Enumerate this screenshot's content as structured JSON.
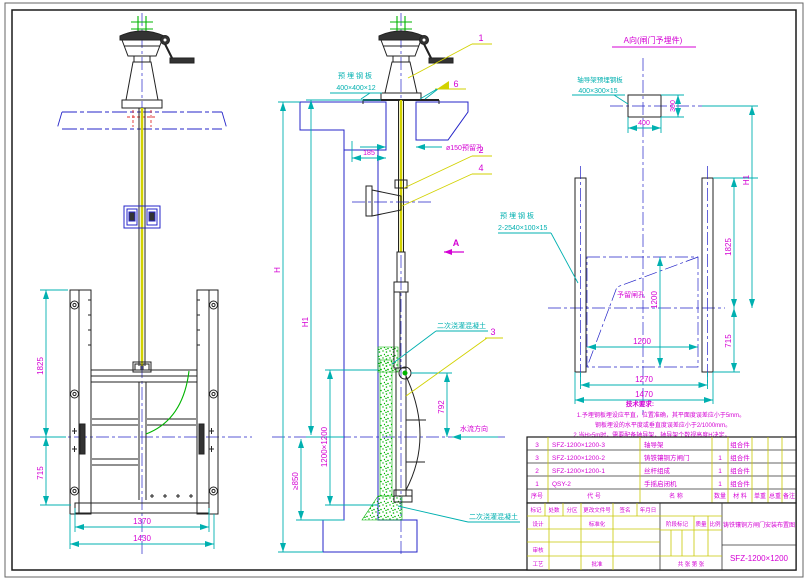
{
  "colors": {
    "dimension_lines": "#00b0b0",
    "dimension_text": "#d400d4",
    "concrete_hatch": "#00b400",
    "structure": "#2424c8",
    "leader_lines": "#d2d200",
    "background": "#ffffff"
  },
  "front": {
    "dims": {
      "h_upper": "1825",
      "h_lower": "715",
      "w_inner": "1370",
      "w_outer": "1430"
    }
  },
  "section": {
    "embed_plate_label": [
      "预埋钢板",
      "400×400×12"
    ],
    "hole_label": "ø150预留孔",
    "offset": "185",
    "H": "H",
    "H1": "H1",
    "opening": "1200×1200",
    "pit_depth": "≥850",
    "d792": "792",
    "flow": "水流方向",
    "section_mark": "A",
    "concrete_top": "二次浇灌混凝土",
    "concrete_bottom": "二次浇灌混凝土",
    "balloons": {
      "b1": "1",
      "b2": "2",
      "b3": "3",
      "b4": "4",
      "b6": "6"
    }
  },
  "embed": {
    "title": "A向(闸门予埋件)",
    "guide_plate_label": [
      "轴导架预埋钢板",
      "400×300×15"
    ],
    "embed_plate_label": [
      "预埋钢板",
      "2-2540×100×15"
    ],
    "hole_label": "予留闸孔",
    "dims": {
      "d300": "300",
      "d400": "400",
      "H1": "H1",
      "d1825": "1825",
      "d715": "715",
      "v1200": "1200",
      "h1200": "1200",
      "d1270": "1270",
      "d1470": "1470"
    }
  },
  "notes": {
    "title": "技术要求:",
    "lines": [
      "1.予埋钢板埋设应平直，位置准确，其平面度误差应小于5mm。",
      "钢板埋设的水平度或垂直度误差应小于2/1000mm。",
      "2.当H≥5m时，需要配备轴导架，轴导架个数视高度H决定。"
    ]
  },
  "parts": {
    "headers": [
      "序号",
      "代  号",
      "名  称",
      "数量",
      "材  料",
      "单重",
      "总重",
      "备注"
    ],
    "rows": [
      {
        "no": "3",
        "code": "SFZ-1200×1200-3",
        "name": "轴导架",
        "qty": "",
        "mat": "组合件"
      },
      {
        "no": "3",
        "code": "SFZ-1200×1200-2",
        "name": "铸铁镶铜方闸门",
        "qty": "1",
        "mat": "组合件"
      },
      {
        "no": "2",
        "code": "SFZ-1200×1200-1",
        "name": "丝杆组成",
        "qty": "1",
        "mat": "组合件"
      },
      {
        "no": "1",
        "code": "QSY-2",
        "name": "手摇启闭机",
        "qty": "1",
        "mat": "组合件"
      }
    ]
  },
  "tb": {
    "rev": [
      "标记",
      "处数",
      "分区",
      "更改文件号",
      "签名",
      "年月日"
    ],
    "design": "设计",
    "standardize": "标准化",
    "check": "审核",
    "craft": "工艺",
    "approve": "批准",
    "stage": "阶段标记",
    "mass": "质量",
    "scale": "比例",
    "sheet": "共  张  第  张",
    "title": "铸铁镶铜方闸门安装布置图",
    "code": "SFZ-1200×1200"
  }
}
